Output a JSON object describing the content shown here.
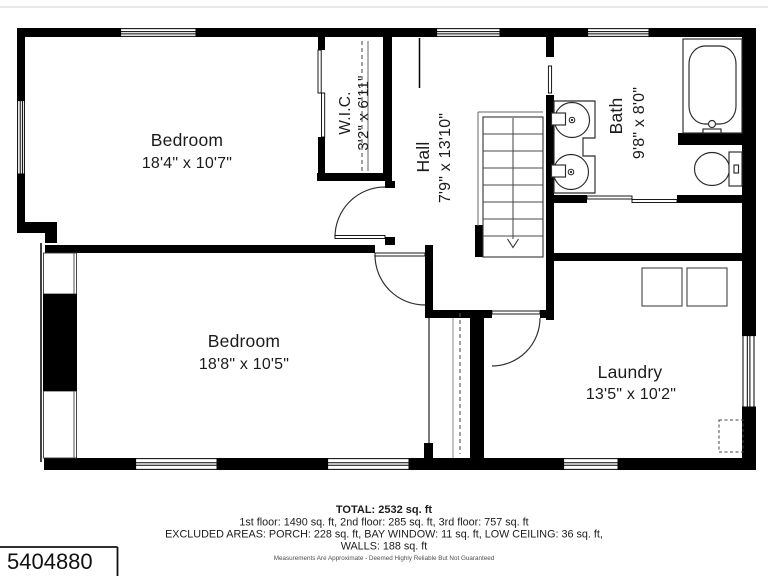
{
  "floorplan": {
    "rooms": {
      "bedroom1": {
        "name": "Bedroom",
        "dims": "18'4\" x 10'7\""
      },
      "wic": {
        "name": "W.I.C.",
        "dims": "3'2\" x 6'11\""
      },
      "hall": {
        "name": "Hall",
        "dims": "7'9\" x 13'10\""
      },
      "bath": {
        "name": "Bath",
        "dims": "9'8\" x 8'0\""
      },
      "bedroom2": {
        "name": "Bedroom",
        "dims": "18'8\" x 10'5\""
      },
      "laundry": {
        "name": "Laundry",
        "dims": "13'5\" x 10'2\""
      }
    },
    "fixtures": [
      "bathtub",
      "toilet",
      "sink",
      "sink",
      "washer",
      "dryer",
      "staircase-down"
    ],
    "colors": {
      "wall": "#000000",
      "background": "#ffffff"
    }
  },
  "footer": {
    "total": "TOTAL: 2532 sq. ft",
    "floors": "1st floor: 1490 sq. ft, 2nd floor: 285 sq. ft, 3rd floor: 757 sq. ft",
    "excluded": "EXCLUDED AREAS: PORCH: 228 sq. ft, BAY WINDOW: 11 sq. ft, LOW CEILING: 36 sq. ft,",
    "walls": "WALLS: 188 sq. ft",
    "disclaimer": "Measurements Are Approximate - Deemed Highly Reliable But Not Guaranteed"
  },
  "listing_id": "5404880"
}
